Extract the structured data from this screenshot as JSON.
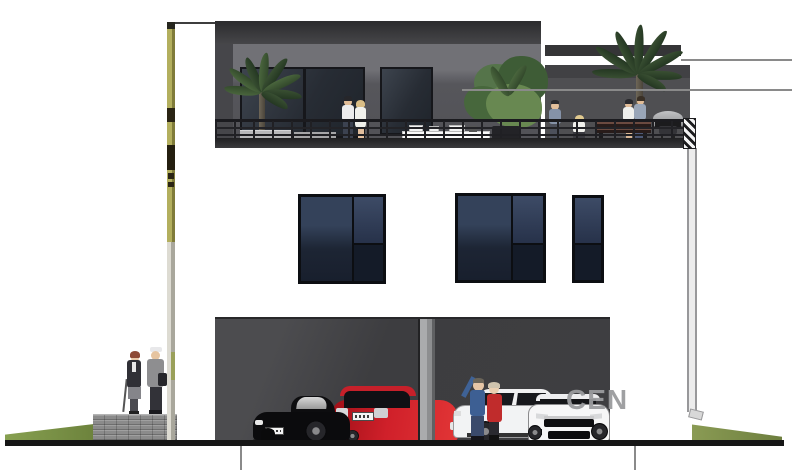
{
  "watermark": {
    "text": "CEN"
  },
  "drawing": {
    "kind": "house-front-elevation-render",
    "levels": [
      "garage-level",
      "window-level",
      "roof-terrace-level"
    ],
    "annotations": {
      "top_horizontal_leader_lines": 2,
      "bottom_vertical_leader_lines": 2,
      "survey_pole_left": true
    },
    "vehicles": [
      "black-roadster",
      "red-hatchback",
      "white-sedan",
      "white-coupe"
    ],
    "people_groups": [
      "couple-on-left-walkway",
      "couple-on-terrace",
      "man-on-terrace",
      "seated-woman-on-terrace",
      "two-women-on-terrace",
      "couple-in-garage"
    ],
    "vegetation": [
      "palm-left",
      "shrub-center",
      "palm-right",
      "grass-bank-left",
      "grass-bank-right"
    ],
    "terrace_items": [
      "metal-railing",
      "white-table",
      "planters",
      "wood-bench",
      "barbecue-grill",
      "hatched-corner-post"
    ]
  },
  "colors": {
    "facade": "#ffffff",
    "roof_parapet": "#343336",
    "terrace_back_wall": "#57565b",
    "right_wall": "#4e4e51",
    "window_glass_dark": "#1c2230",
    "window_glass_light": "#3c4a64",
    "garage_interior": "#404043",
    "garage_pillar": "#a9aaac",
    "ground_line": "#161616",
    "grass": "#7d9449",
    "survey_pole": "#a5a151",
    "masonry_wall": "#8f8f8f",
    "car_black": "#0b0b0d",
    "car_red": "#cf1f29",
    "car_white": "#f3f3f4",
    "railing": "#1d1d21",
    "leader_line": "#8a8a8a",
    "watermark": "#9a9b9e"
  }
}
